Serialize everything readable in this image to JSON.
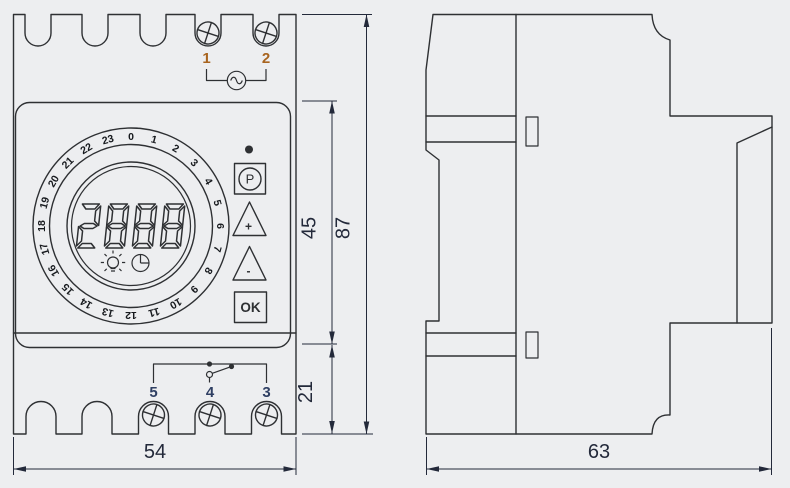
{
  "drawing": {
    "type": "technical-dimension-drawing",
    "subject": "DIN-rail digital time switch, front and side views"
  },
  "colors": {
    "bg": "#edeef0",
    "line": "#2e3033",
    "dim": "#23293a",
    "label-top": "#a8641f",
    "label-bottom": "#2f3f63",
    "digit": "#16191d"
  },
  "front_view": {
    "terminals_top": {
      "labels": [
        "1",
        "2"
      ],
      "symbol": "ac-source"
    },
    "terminals_bottom": {
      "labels": [
        "5",
        "4",
        "3"
      ],
      "symbol": "changeover-contact"
    },
    "dial": {
      "hours": [
        "0",
        "1",
        "2",
        "3",
        "4",
        "5",
        "6",
        "7",
        "8",
        "9",
        "10",
        "11",
        "12",
        "13",
        "14",
        "15",
        "16",
        "17",
        "18",
        "19",
        "20",
        "21",
        "22",
        "23"
      ]
    },
    "display": {
      "value": "2888"
    },
    "indicators": {
      "led": "led-dot",
      "icons": [
        "bulb-icon",
        "clock-icon"
      ]
    },
    "buttons": {
      "program": "P",
      "up": "+",
      "down": "-",
      "ok": "OK"
    }
  },
  "dimensions": {
    "front_width": "54",
    "side_depth": "63",
    "panel_height": "45",
    "total_height": "87",
    "terminal_height": "21"
  }
}
